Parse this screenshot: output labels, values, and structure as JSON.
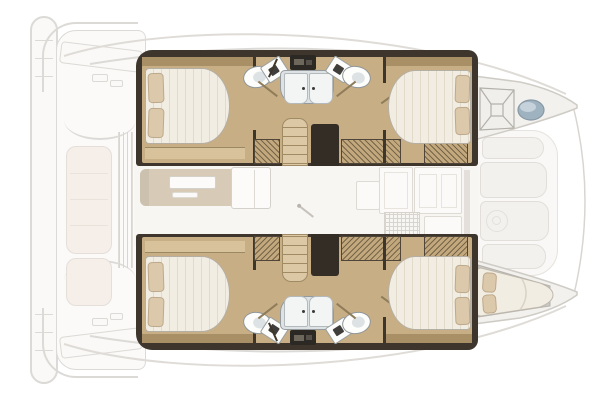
{
  "title": "catamaran-interior-floor-plan",
  "colors": {
    "wall": "#3e362c",
    "wall2": "#2c2823",
    "floor": "#c8ae85",
    "floor_l": "#d8c29c",
    "shelf": "#a98f66",
    "locker": "#c2a87c",
    "stair": "#dcc8a4",
    "stair_ln": "#a08a64",
    "mattress": "#f2ede3",
    "mattress_st": "#e2dacb",
    "pillow": "#dcc9ab",
    "pillow_edge": "#bda98a",
    "shower": "#dde2e4",
    "shower_bd": "#959a9d",
    "shower_door": "#f3f5f5",
    "fix_white": "#fdfdfc",
    "fix_border": "#8f9699",
    "hatch": "#9fb2c0",
    "line": "#dcdad6",
    "faded": "#faf9f7",
    "faded2": "#f3f1ee",
    "cushion": "#f6eee9",
    "sofa": "#cfc0a9",
    "sofa_sh": "#b8ab96"
  }
}
